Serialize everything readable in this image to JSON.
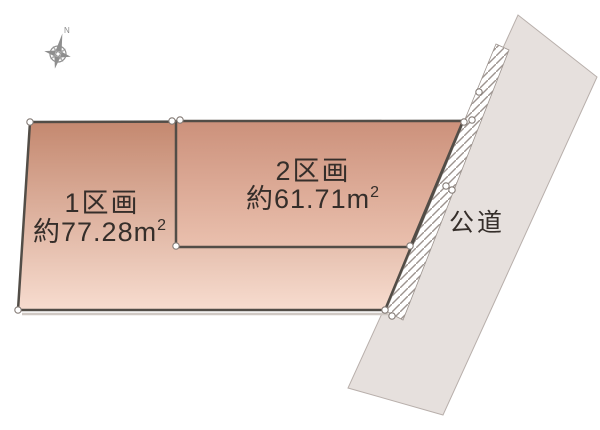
{
  "diagram": {
    "type": "land-plot-layout",
    "compass": {
      "north_label": "N"
    },
    "parcels": [
      {
        "name": "1区画",
        "area_label": "約77.28m",
        "area_sup": "2"
      },
      {
        "name": "2区画",
        "area_label": "約61.71m",
        "area_sup": "2"
      }
    ],
    "road": {
      "label": "公道"
    },
    "colors": {
      "parcel1_top": "#c4886f",
      "parcel1_bottom": "#f7dccf",
      "parcel2_top": "#cc917b",
      "parcel2_bottom": "#eac0ae",
      "parcel_border": "#524d47",
      "road_fill": "#e6e0dd",
      "road_border": "#b8afab",
      "hatch_line": "#9d948f",
      "shadow_line": "#cfc8c3",
      "marker_stroke": "#857c77",
      "compass_color": "#8e8e8e",
      "label_color": "#352e2a"
    }
  }
}
